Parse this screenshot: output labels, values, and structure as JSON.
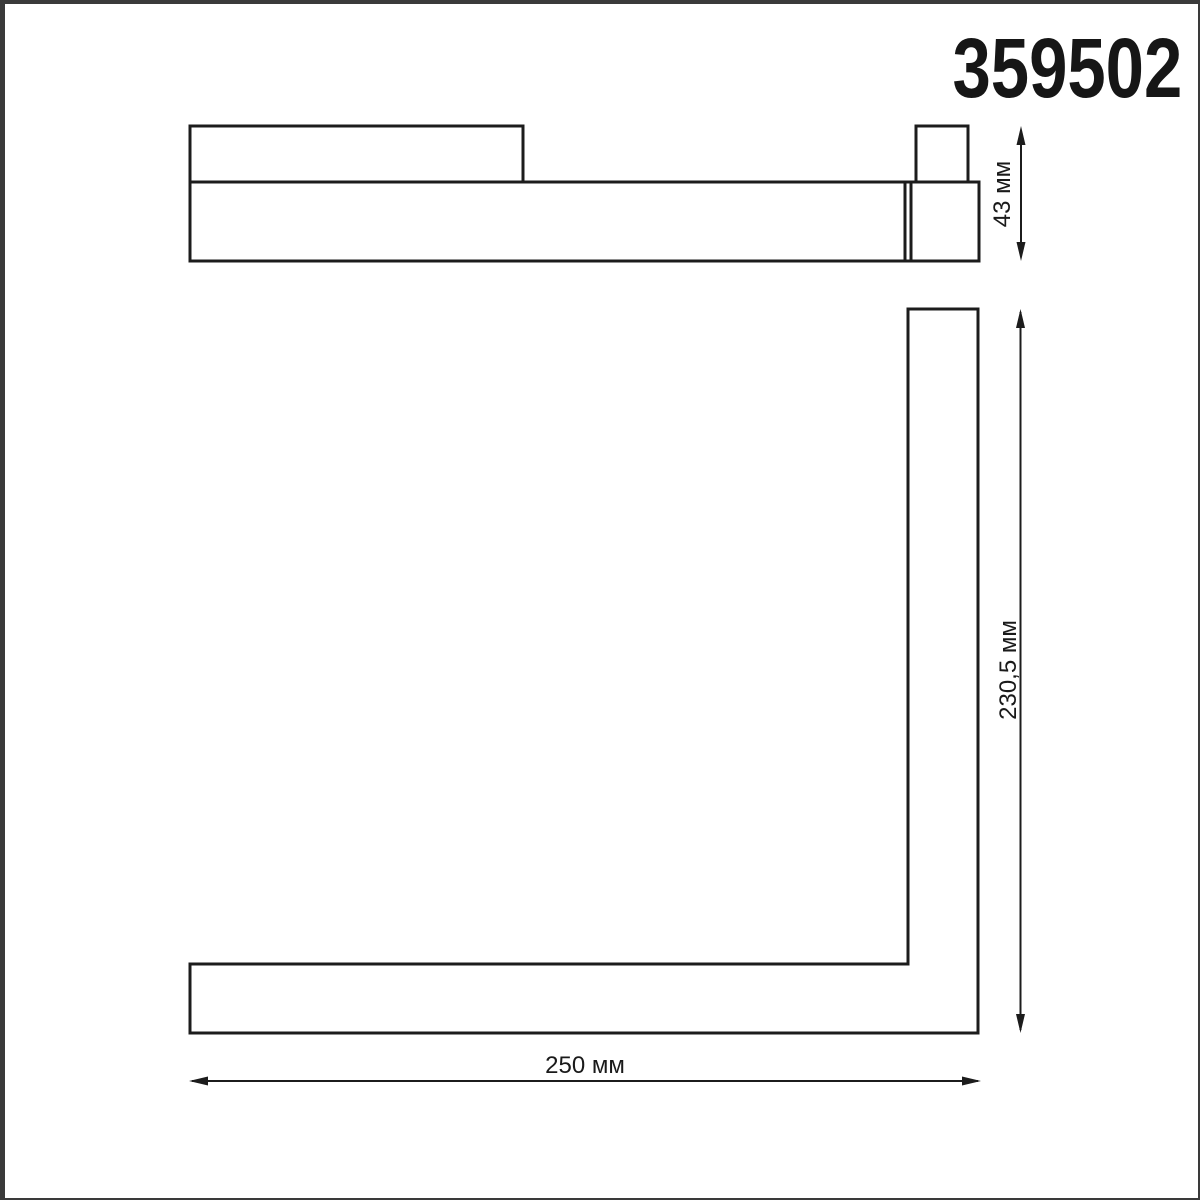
{
  "title": "359502",
  "dimensions": {
    "height": {
      "label": "43 мм",
      "value": 43,
      "unit": "мм"
    },
    "depth": {
      "label": "230,5 мм",
      "value": 230.5,
      "unit": "мм"
    },
    "width": {
      "label": "250 мм",
      "value": 250,
      "unit": "мм"
    }
  },
  "colors": {
    "line": "#1c1c1c",
    "text": "#1a1a1a",
    "frame_border": "#3a3a3a",
    "background": "#ffffff"
  }
}
